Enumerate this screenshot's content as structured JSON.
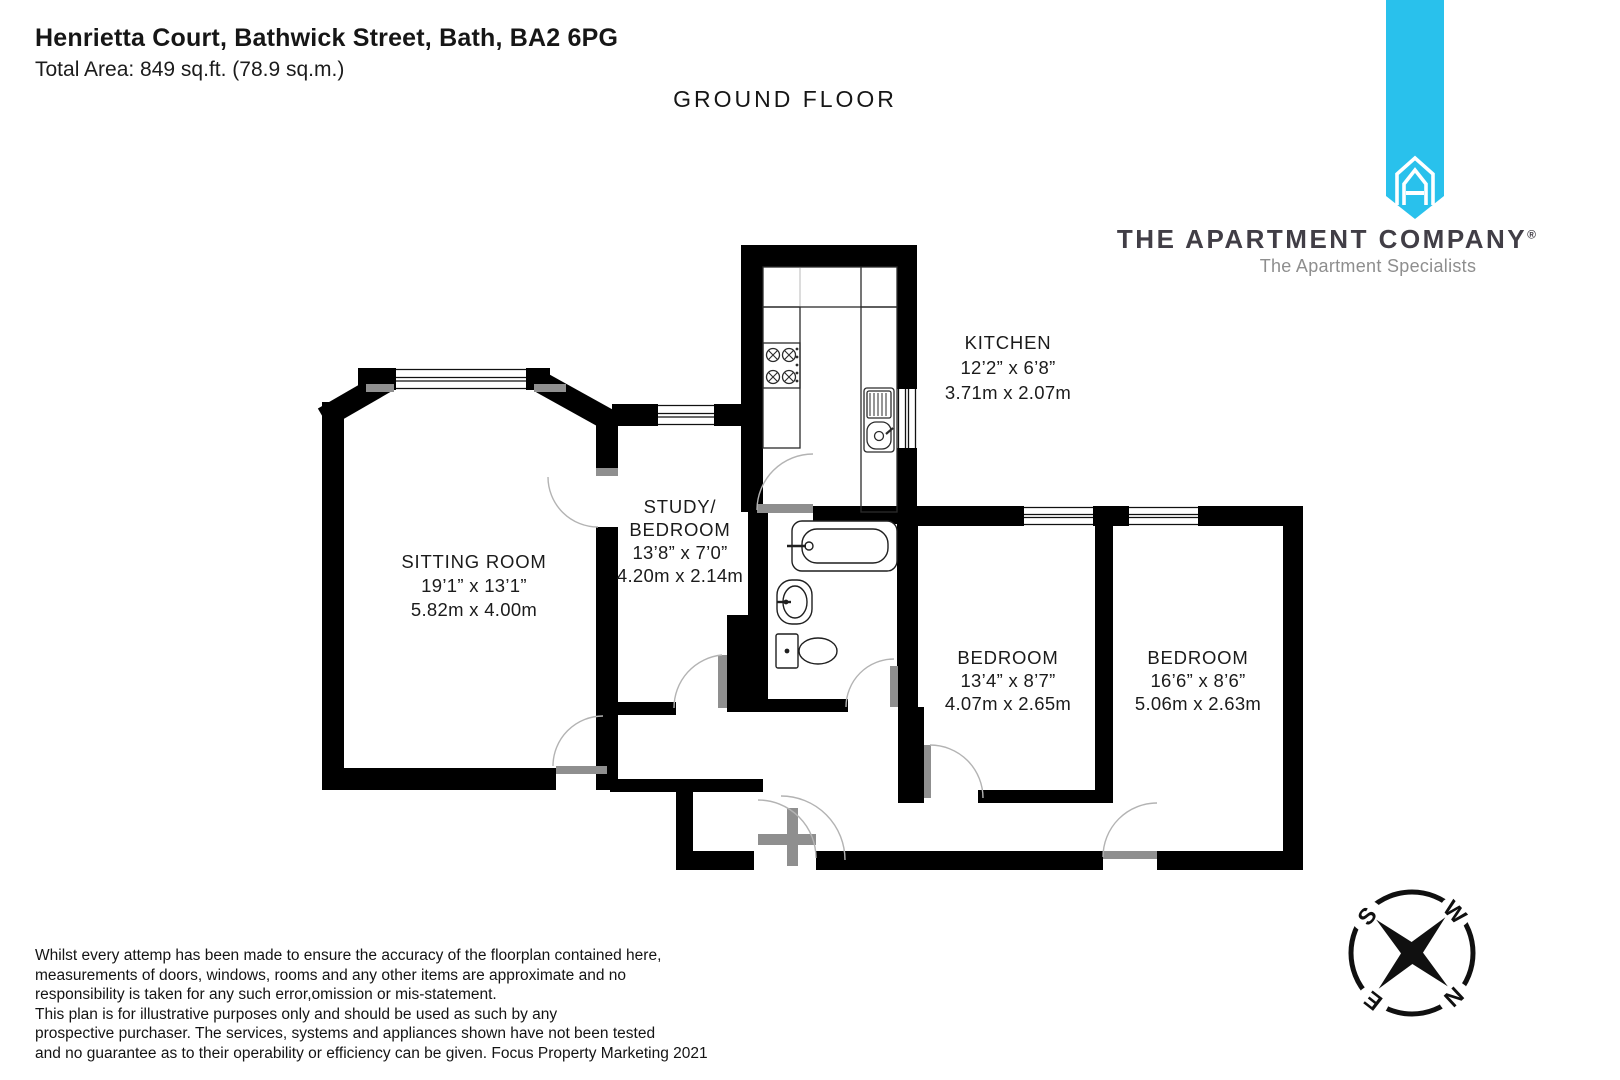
{
  "header": {
    "address": "Henrietta Court, Bathwick Street, Bath, BA2 6PG",
    "total_area": "Total Area: 849 sq.ft. (78.9 sq.m.)",
    "floor_label": "GROUND FLOOR"
  },
  "branding": {
    "company_name": "THE APARTMENT COMPANY",
    "registered_symbol": "®",
    "tagline": "The Apartment Specialists",
    "ribbon_color": "#29C1EC"
  },
  "rooms": {
    "sitting_room": {
      "name": "SITTING ROOM",
      "imperial": "19’1” x 13’1”",
      "metric": "5.82m x 4.00m"
    },
    "study_bedroom": {
      "name_line1": "STUDY/",
      "name_line2": "BEDROOM",
      "imperial": "13’8” x 7’0”",
      "metric": "4.20m x 2.14m"
    },
    "kitchen": {
      "name": "KITCHEN",
      "imperial": "12’2” x 6’8”",
      "metric": "3.71m x 2.07m"
    },
    "bedroom_middle": {
      "name": "BEDROOM",
      "imperial": "13’4” x 8’7”",
      "metric": "4.07m x 2.65m"
    },
    "bedroom_right": {
      "name": "BEDROOM",
      "imperial": "16’6” x 8’6”",
      "metric": "5.06m x 2.63m"
    }
  },
  "compass": {
    "north": "N",
    "south": "S",
    "east": "E",
    "west": "W"
  },
  "disclaimer": {
    "lines": [
      "Whilst every attemp has been made to ensure the accuracy of the floorplan contained here,",
      "measurements of doors, windows, rooms and any other items are approximate and no",
      "responsibility is taken for any such error,omission or mis-statement.",
      "This plan is for illustrative purposes only and should be used as such by any",
      "prospective purchaser. The services, systems and appliances shown have not been tested",
      "and no guarantee as to their operability or efficiency can be given. Focus Property Marketing 2021"
    ]
  }
}
